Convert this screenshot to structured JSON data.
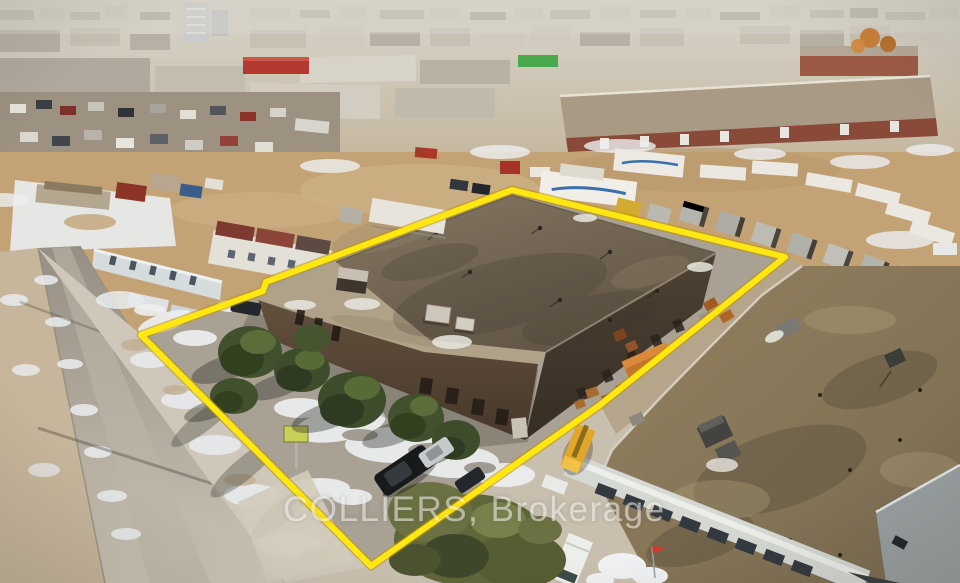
{
  "watermark": {
    "text": "COLLIERS, Brokerage",
    "color": "rgba(255,255,255,0.52)"
  },
  "boundary": {
    "points": "141,335 263,291 266,282 512,190 785,257 600,405 371,566",
    "color": "#ffe712",
    "glow_color": "#bd9200"
  },
  "palette": {
    "subject_roof": "#6f6250",
    "subject_wall": "#54422f",
    "dirt": "#c3a376",
    "snow": "#edeff1",
    "road": "#a8a094",
    "parcel_pavement": "#a8a194",
    "neighbor_roof": "#857458",
    "tree_evergreen": "#41502d",
    "tree_canopy": "#5f6639"
  }
}
